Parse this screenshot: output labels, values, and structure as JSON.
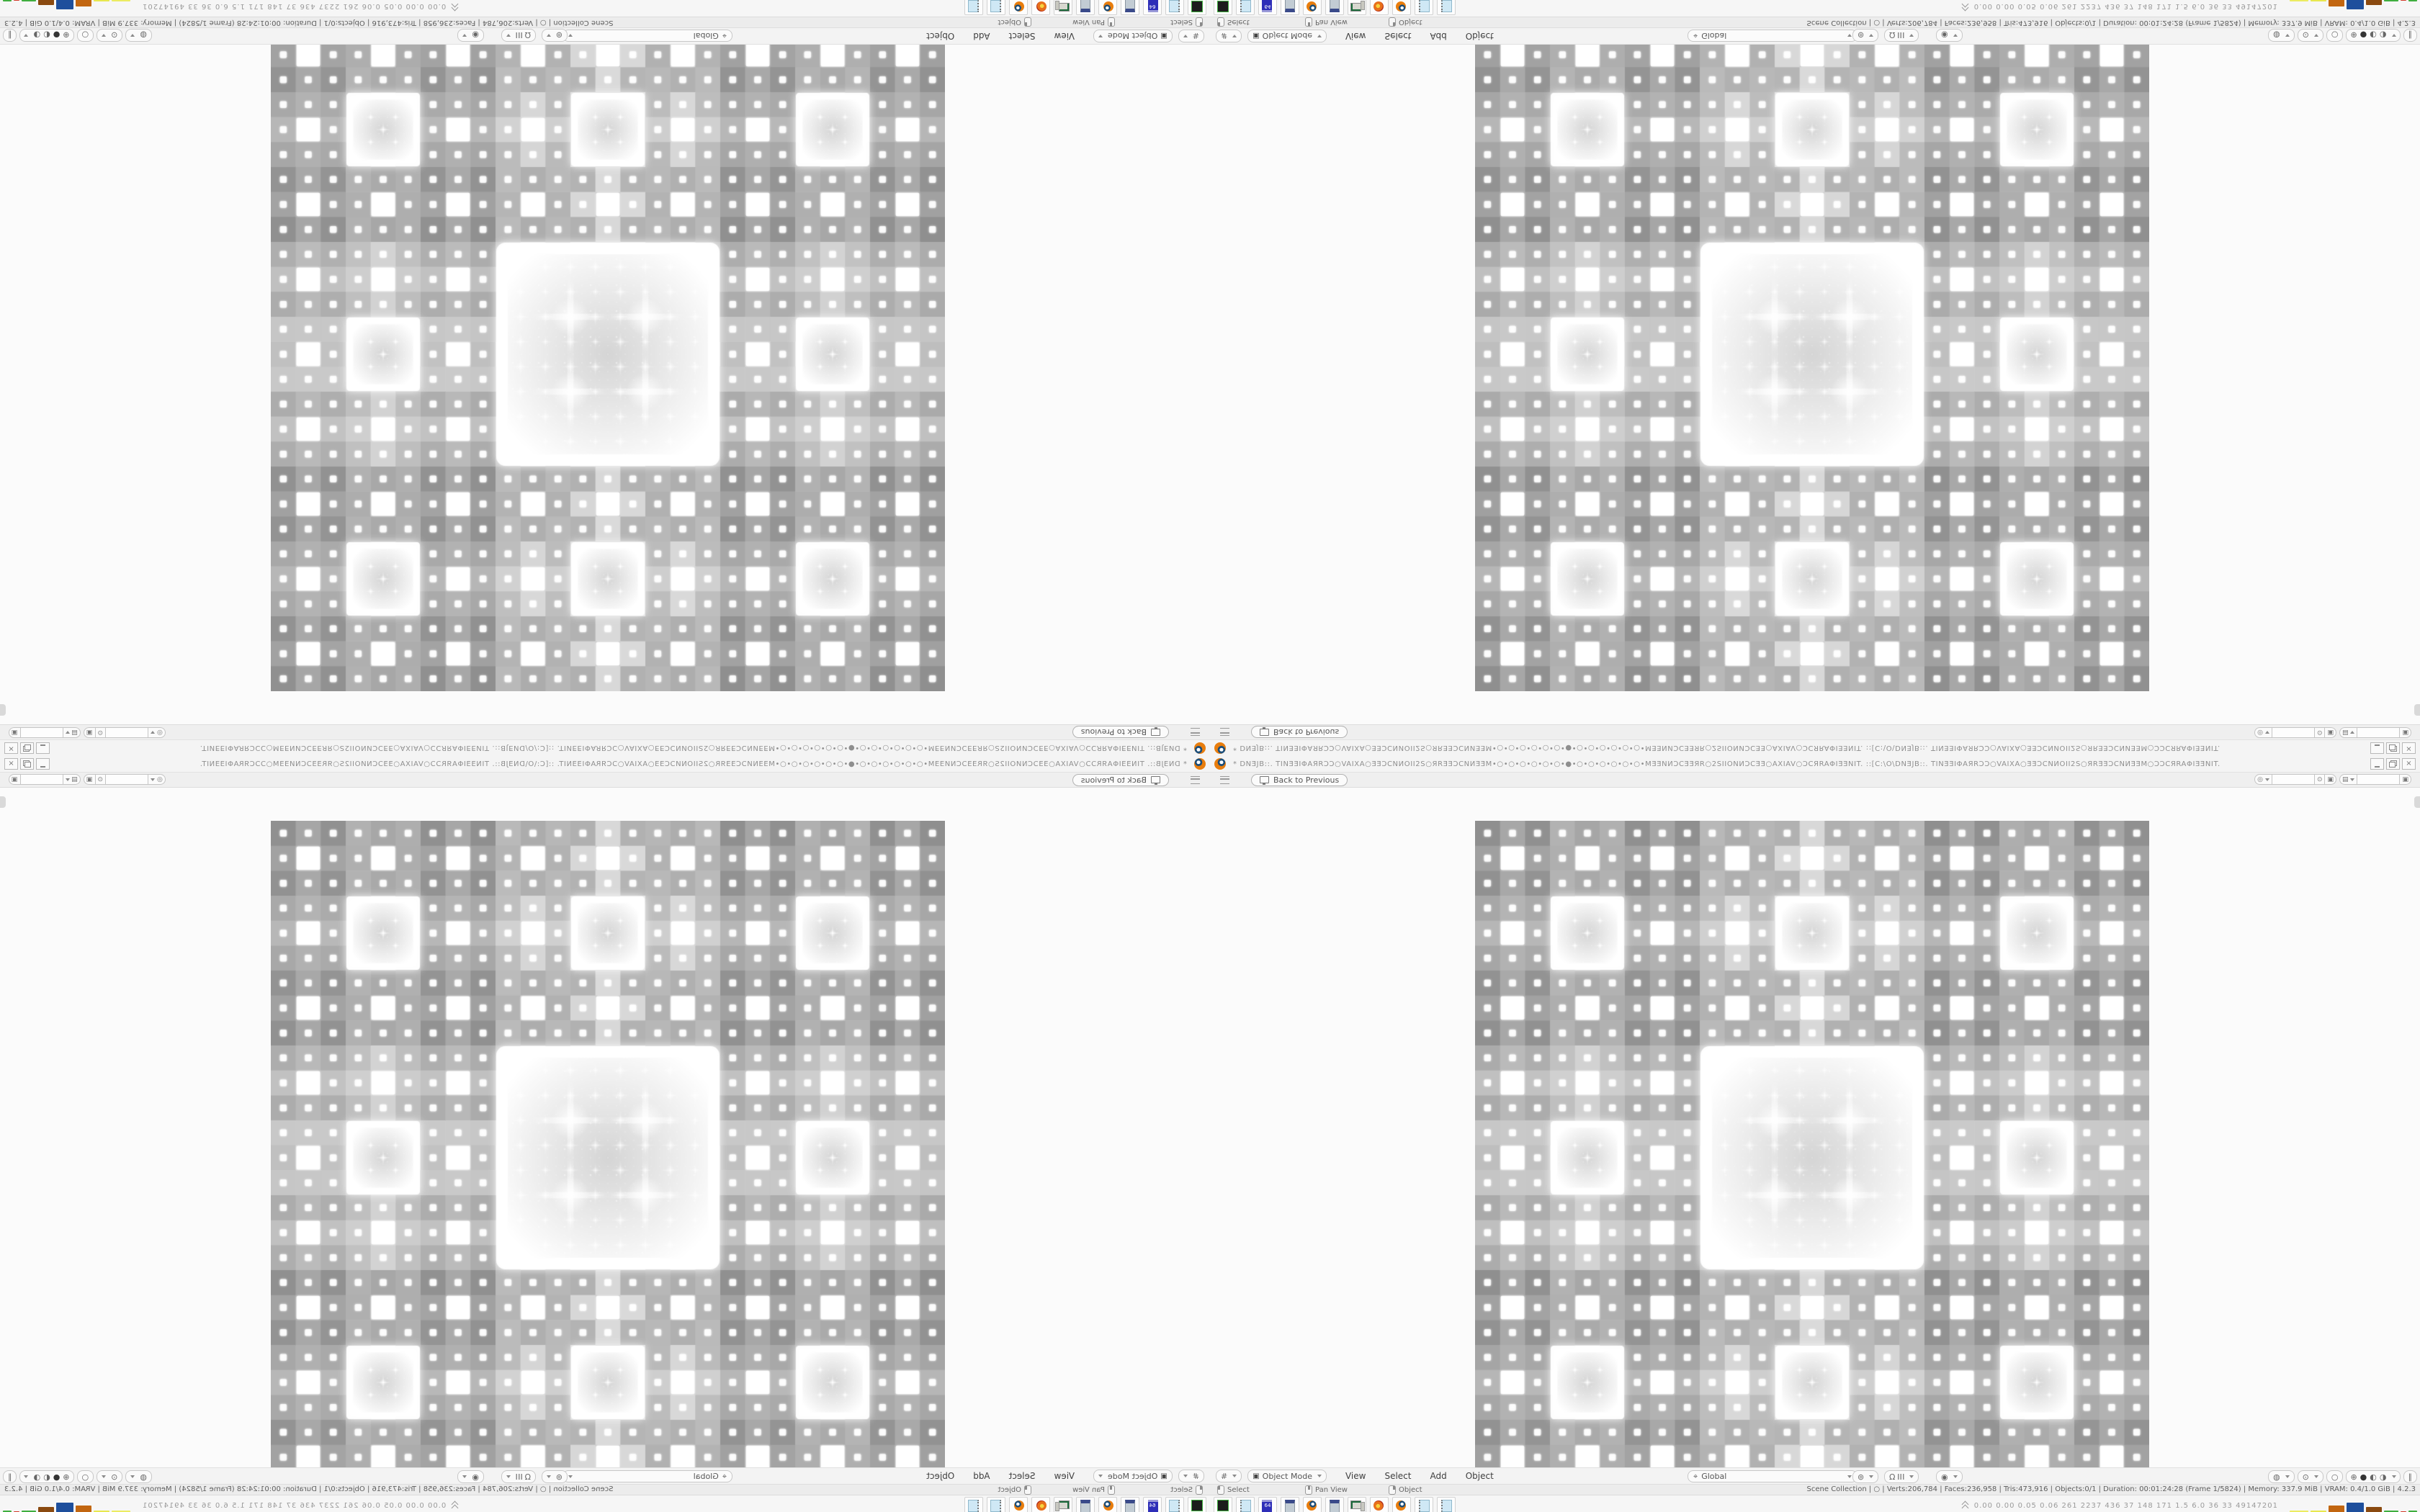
{
  "app": {
    "quadrants": [
      {
        "name": "quadrant-top-left",
        "css": "quad q-tl"
      },
      {
        "name": "quadrant-top-right",
        "css": "quad q-tr"
      },
      {
        "name": "quadrant-bottom-left",
        "css": "quad q-bl"
      },
      {
        "name": "quadrant-bottom-right",
        "css": "quad q-br"
      }
    ]
  },
  "window": {
    "title_bar": {
      "title_text": "* DNƎJB::. TINƎƎIΦAЯRƆƆ○VAIXA○ƎƎƆCNИOII2S○ЯRƎƎƆCNИƎƎM•○•○•○•○•○•○•●•○•○•○•○•○•○•MƎƎNИƆCƎƎЯR○2SIIONИƆCƎƎ○AXIAV○ƆCЯRAΦIƎƎNIT. ::[C:\\O\\DNƎJB::. TINƎƎIΦAЯRƆƆ○VAIXA○ƎƎƆCNИOII2S○ЯRƎƎƆCNИƎƎM○ƆƆCЯRAΦIƎƎNIT.",
      "close_glyph": "×"
    },
    "topbar": {
      "back_label": "Back to Previous",
      "scene_icon_glyph": "◎",
      "scene_value": "",
      "pin_glyph": "⊙",
      "copy_glyph": "▣",
      "layer_icon_glyph": "▤",
      "layer_value": ""
    },
    "header": {
      "editor_glyph": "#",
      "mode_icon_glyph": "▣",
      "mode_label": "Object Mode",
      "menus": [
        "View",
        "Select",
        "Add",
        "Object"
      ],
      "orientation_icon_glyph": "⌖",
      "orientation_label": "Global",
      "falloff_glyph": "⊚",
      "snap_glyph": "Ω",
      "proportional_glyph": "◉",
      "gizmo_glyph": "◍",
      "overlay_glyph": "⊙",
      "xray_glyph": "○",
      "shading_glyphs": [
        "⊕",
        "●",
        "◐",
        "◑"
      ],
      "pause_glyph": "∥"
    },
    "status": {
      "hints": [
        {
          "label": "Select"
        },
        {
          "label": "Pan View"
        },
        {
          "label": "Object"
        }
      ],
      "info": "Scene Collection  |  ○  |  Verts:206,784 | Faces:236,958 | Tris:473,916 | Objects:0/1 | Duration: 00:01:24:28 (Frame 1/5824) | Memory: 337.9 MiB | VRAM: 0.4/1.0 GiB  |  4.2.3"
    },
    "taskbar": {
      "icons": [
        {
          "css": "ticon ticon-diskdark",
          "label": ""
        },
        {
          "css": "ticon ticon-notepad",
          "label": ""
        },
        {
          "css": "ticon ticon-floppy64",
          "label": "64"
        },
        {
          "css": "ticon ticon-calc",
          "label": ""
        },
        {
          "css": "ticon ticon-blender",
          "label": ""
        },
        {
          "css": "ticon ticon-calc",
          "label": ""
        },
        {
          "css": "ticon ticon-computer",
          "label": ""
        },
        {
          "css": "ticon ticon-firefox",
          "label": ""
        },
        {
          "css": "ticon ticon-blender",
          "label": ""
        },
        {
          "css": "ticon ticon-notepad",
          "label": ""
        },
        {
          "css": "ticon ticon-notepad",
          "label": ""
        }
      ],
      "monitor_values": "0.00 0.00 0.05 0.06  261 2237 436  37  148  171  1.5  6.0  36  33  49147201",
      "bars": [
        {
          "style": "width:26px;height:4px;background:#ecec62"
        },
        {
          "style": "width:22px;height:4px;background:#e8e84f"
        },
        {
          "style": "width:22px;height:11px;background:#c26610"
        },
        {
          "style": "width:24px;height:15px;background:#1e4f9c"
        },
        {
          "style": "width:22px;height:9px;background:#8a4a10"
        },
        {
          "style": "width:20px;height:4px;background:#3fae3f"
        },
        {
          "style": "width:8px;height:3px;background:#d23b2a"
        },
        {
          "style": "width:12px;height:4px;background:#3fae3f"
        }
      ]
    }
  },
  "fractal": {
    "size": 936,
    "grid": 27,
    "depth": 4,
    "band_base": 150,
    "band_d0": 24,
    "band_d1": 38,
    "band_d2": 50,
    "bg": "#fafafa",
    "interior": "#d5d5d5",
    "white": "#ffffff"
  }
}
